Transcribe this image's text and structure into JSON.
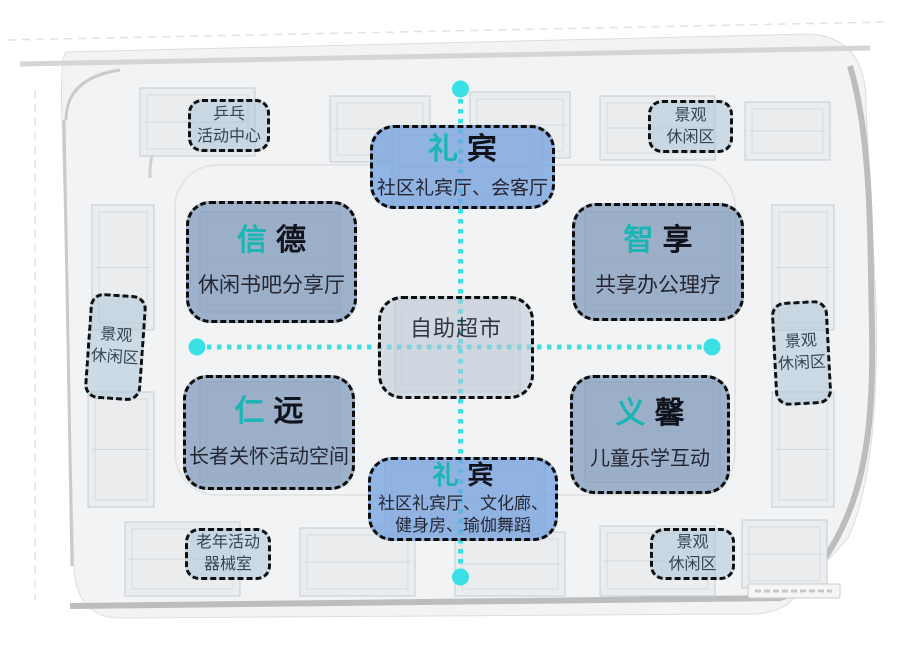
{
  "colors": {
    "accent_teal": "#1ab5b5",
    "axis_cyan": "#3ae0e4",
    "zone_blue_fill": "#a9c5e9",
    "zone_slate_fill": "#9db1c9",
    "zone_center_fill": "#cdd5e0",
    "amenity_fill": "#c7d7e2",
    "border_black": "#0b0b0b"
  },
  "zones": {
    "reception_top": {
      "accent": "礼",
      "rest": "宾",
      "subtitle": "社区礼宾厅、会客厅"
    },
    "xinde": {
      "accent": "信",
      "rest": "德",
      "subtitle": "休闲书吧分享厅"
    },
    "zhixiang": {
      "accent": "智",
      "rest": "享",
      "subtitle": "共享办公理疗"
    },
    "market": {
      "label": "自助超市"
    },
    "renyuan": {
      "accent": "仁",
      "rest": "远",
      "subtitle": "长者关怀活动空间"
    },
    "yixin": {
      "accent": "义",
      "rest": "馨",
      "subtitle": "儿童乐学互动"
    },
    "reception_bottom": {
      "accent": "礼",
      "rest": "宾",
      "subtitle_line1": "社区礼宾厅、文化廊、",
      "subtitle_line2": "健身房、瑜伽舞蹈"
    }
  },
  "amenities": {
    "pingpong": {
      "line1": "乒乓",
      "line2": "活动中心"
    },
    "landscape_top_right": {
      "line1": "景观",
      "line2": "休闲区"
    },
    "landscape_left": {
      "line1": "景观",
      "line2": "休闲区"
    },
    "landscape_right": {
      "line1": "景观",
      "line2": "休闲区"
    },
    "elderly_equipment": {
      "line1": "老年活动",
      "line2": "器械室"
    },
    "landscape_bottom_right": {
      "line1": "景观",
      "line2": "休闲区"
    }
  }
}
